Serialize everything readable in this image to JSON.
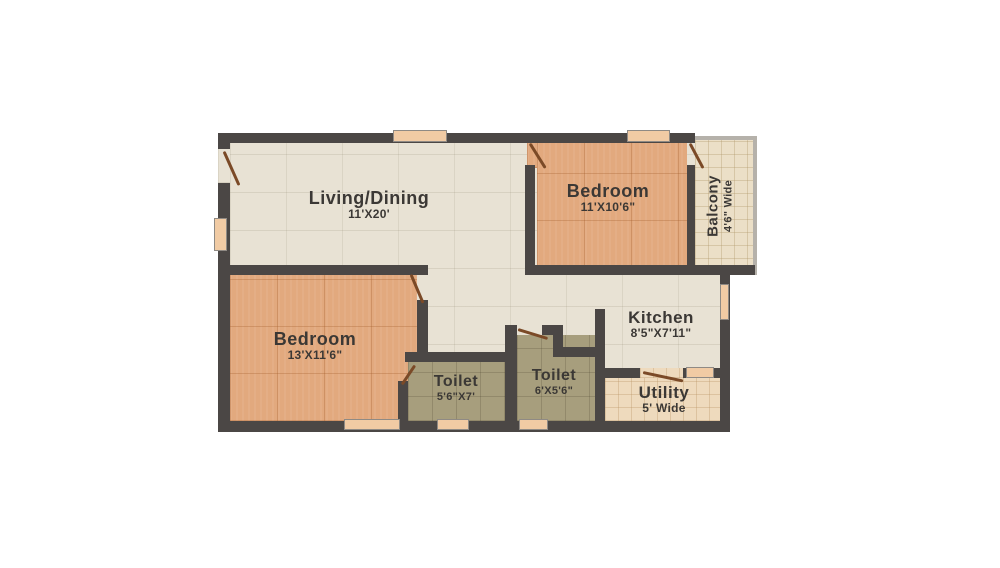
{
  "floor_plan": {
    "rooms": {
      "living_dining": {
        "name": "Living/Dining",
        "dims": "11'X20'"
      },
      "bedroom_top": {
        "name": "Bedroom",
        "dims": "11'X10'6\""
      },
      "balcony": {
        "name": "Balcony",
        "dims": "4'6\" Wide"
      },
      "kitchen": {
        "name": "Kitchen",
        "dims": "8'5\"X7'11\""
      },
      "bedroom_bottom": {
        "name": "Bedroom",
        "dims": "13'X11'6\""
      },
      "toilet_attached": {
        "name": "Toilet",
        "dims": "5'6\"X7'"
      },
      "toilet_common": {
        "name": "Toilet",
        "dims": "6'X5'6\""
      },
      "utility": {
        "name": "Utility",
        "dims": "5' Wide"
      }
    },
    "palette": {
      "background": "#ffffff",
      "wall": "#4b4745",
      "living_floor": "#e8e2d4",
      "bedroom_floor": "#e2a97e",
      "toilet_floor": "#a79e7d",
      "utility_floor": "#eedabd",
      "balcony_floor": "#ebdfc7",
      "window": "#f1cba4",
      "door": "#7b4a27",
      "label_text": "#3b3835"
    }
  }
}
